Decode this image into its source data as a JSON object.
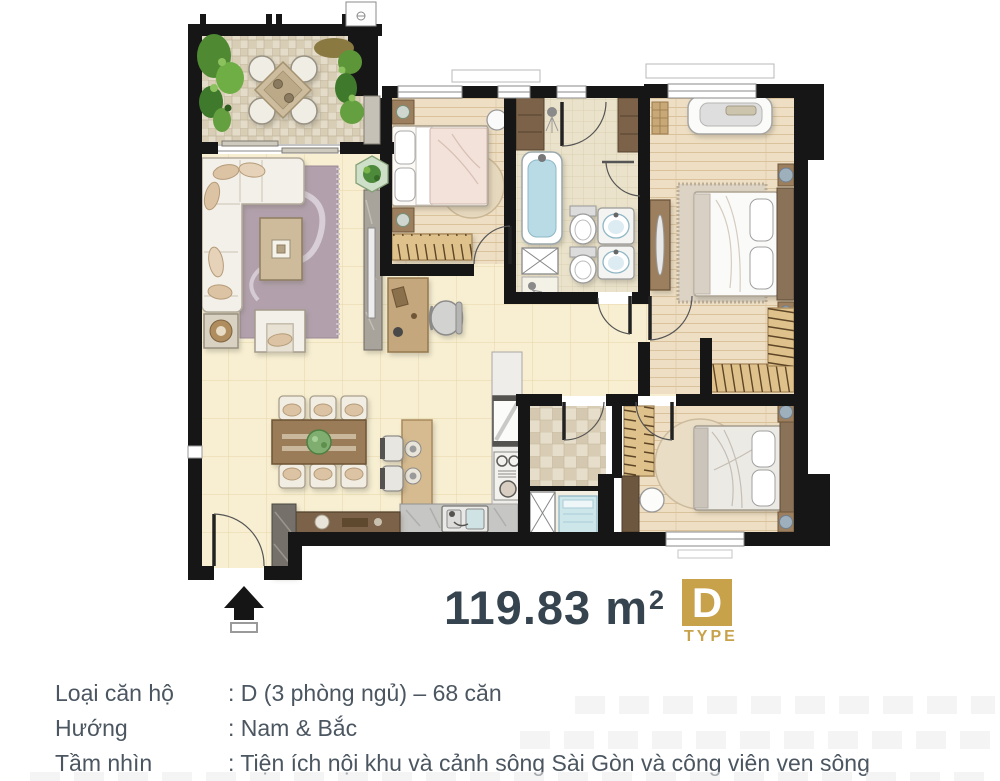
{
  "colors": {
    "accent": "#c8a24b",
    "title": "#35444f",
    "body-text": "#4b5661",
    "wall": "#161616",
    "bg": "#ffffff"
  },
  "area": {
    "value": "119.83 m",
    "superscript": "2"
  },
  "badge": {
    "letter": "D",
    "label": "TYPE"
  },
  "details": {
    "rows": [
      {
        "label": "Loại căn hộ",
        "value": ": D (3 phòng ngủ) – 68 căn"
      },
      {
        "label": "Hướng",
        "value": ": Nam & Bắc"
      },
      {
        "label": "Tầm nhìn",
        "value": ": Tiện ích nội khu và cảnh sông Sài Gòn và công viên ven sông"
      }
    ]
  },
  "floor_plan": {
    "entrance_icon": "up-arrow"
  }
}
